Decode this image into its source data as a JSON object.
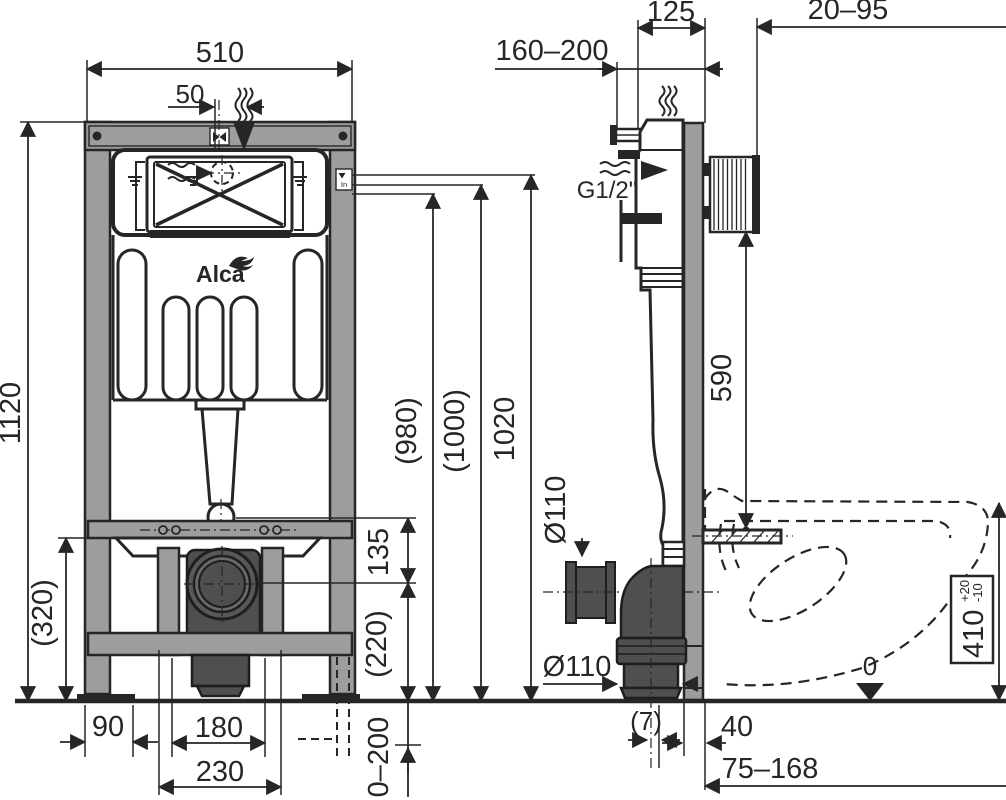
{
  "brand": {
    "logo": "Alca"
  },
  "front": {
    "w510": "510",
    "off50": "50",
    "h1120": "1120",
    "h980": "(980)",
    "h1000": "(1000)",
    "h1020": "1020",
    "v135": "135",
    "v320": "(320)",
    "v220": "(220)",
    "b90": "90",
    "b180": "180",
    "b230": "230",
    "feet": "0–200",
    "level": "In"
  },
  "side": {
    "d125": "125",
    "d2095": "20–95",
    "d160200": "160–200",
    "thread": "G1/2\"",
    "h590": "590",
    "dia_v": "Ø110",
    "dia_h": "Ø110",
    "off7": "(7)",
    "d40": "40",
    "d75168": "75–168",
    "bowl410": "410",
    "tolp": "+20",
    "tolm": "-10",
    "datum": "0"
  }
}
